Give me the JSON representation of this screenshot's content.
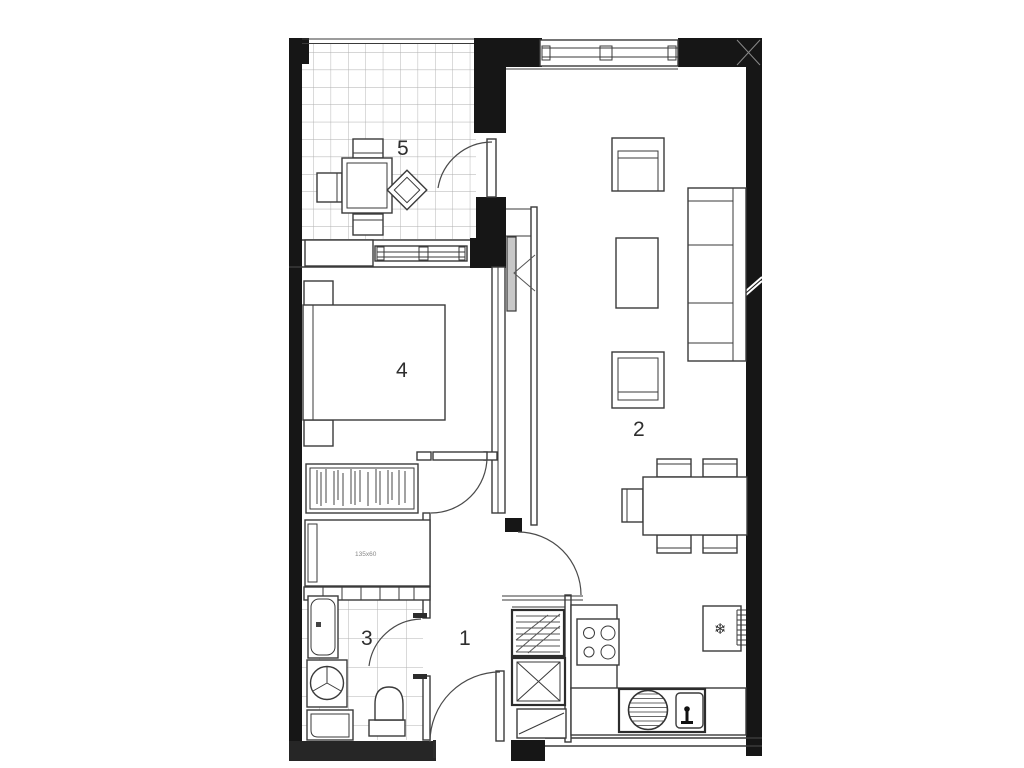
{
  "floor_plan": {
    "room_labels": {
      "hall": "1",
      "living_dining": "2",
      "bathroom": "3",
      "bedroom": "4",
      "balcony": "5"
    },
    "dresser_label": "135x60",
    "icons": {
      "fridge_snowflake": "❄"
    },
    "colors": {
      "wall": "#161616",
      "line": "#3a3a3a",
      "tile_grid": "#b0b0b0",
      "sliding_door_fill": "#c8c8c8"
    }
  }
}
